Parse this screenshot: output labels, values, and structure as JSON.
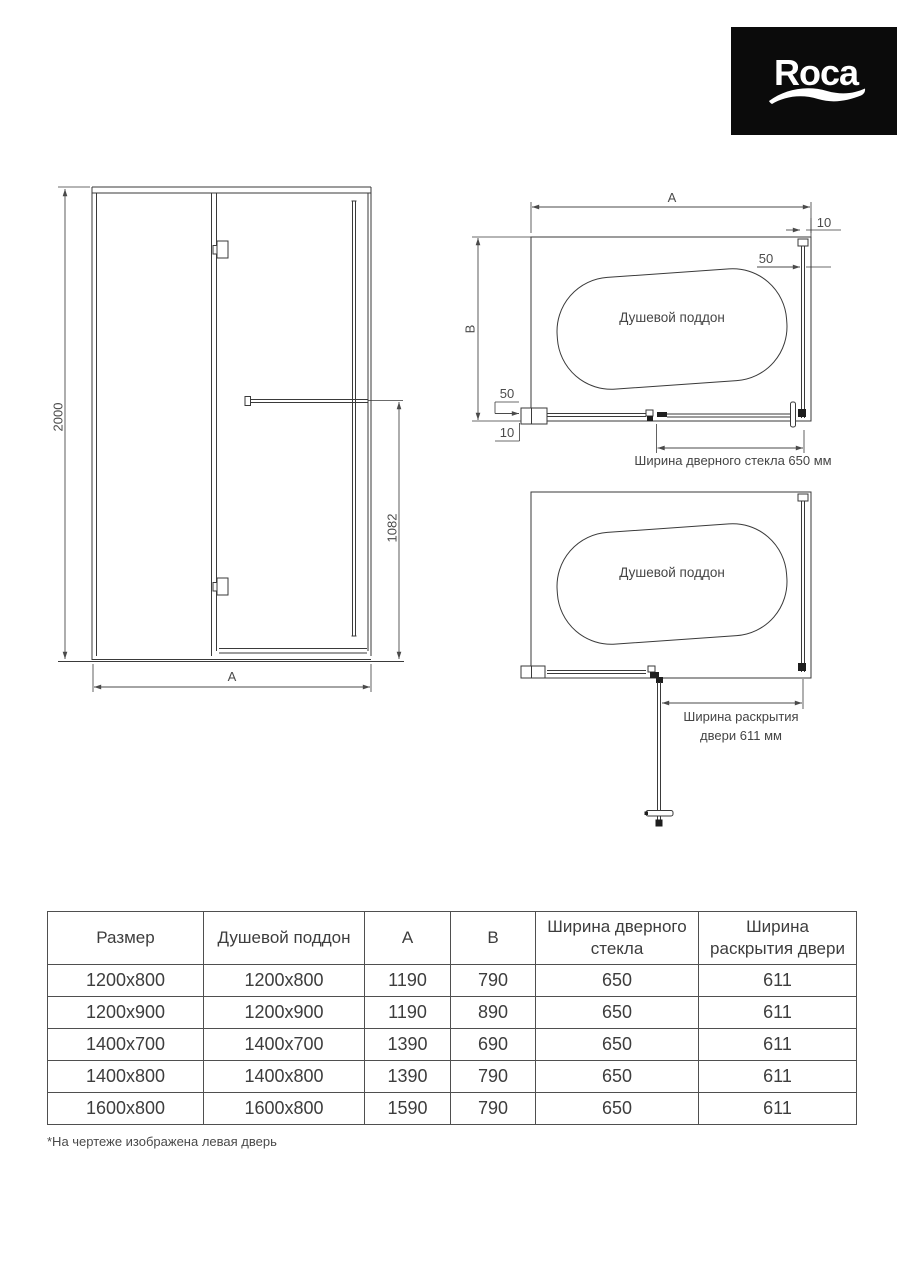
{
  "brand": {
    "logo_text": "Roca"
  },
  "colors": {
    "line": "#3a3a3a",
    "label_text": "#4b4b4b",
    "logo_bg": "#0b0b0b",
    "logo_fg": "#ffffff"
  },
  "front_view": {
    "height_label": "2000",
    "width_label": "A",
    "handle_height_label": "1082"
  },
  "plan_top": {
    "width_label": "A",
    "depth_label": "B",
    "wall_gap_top_label": "10",
    "profile_right_label": "50",
    "profile_bottom_label": "50",
    "wall_gap_bottom_label": "10",
    "tray_label": "Душевой поддон",
    "glass_width_note": "Ширина дверного стекла 650 мм"
  },
  "plan_open": {
    "tray_label": "Душевой поддон",
    "door_opening_note_line1": "Ширина раскрытия",
    "door_opening_note_line2": "двери 611 мм"
  },
  "table": {
    "headers": [
      "Размер",
      "Душевой поддон",
      "A",
      "B",
      "Ширина дверного стекла",
      "Ширина раскрытия двери"
    ],
    "rows": [
      [
        "1200x800",
        "1200x800",
        "1190",
        "790",
        "650",
        "611"
      ],
      [
        "1200x900",
        "1200x900",
        "1190",
        "890",
        "650",
        "611"
      ],
      [
        "1400x700",
        "1400x700",
        "1390",
        "690",
        "650",
        "611"
      ],
      [
        "1400x800",
        "1400x800",
        "1390",
        "790",
        "650",
        "611"
      ],
      [
        "1600x800",
        "1600x800",
        "1590",
        "790",
        "650",
        "611"
      ]
    ]
  },
  "footnote": "*На чертеже изображена левая дверь"
}
